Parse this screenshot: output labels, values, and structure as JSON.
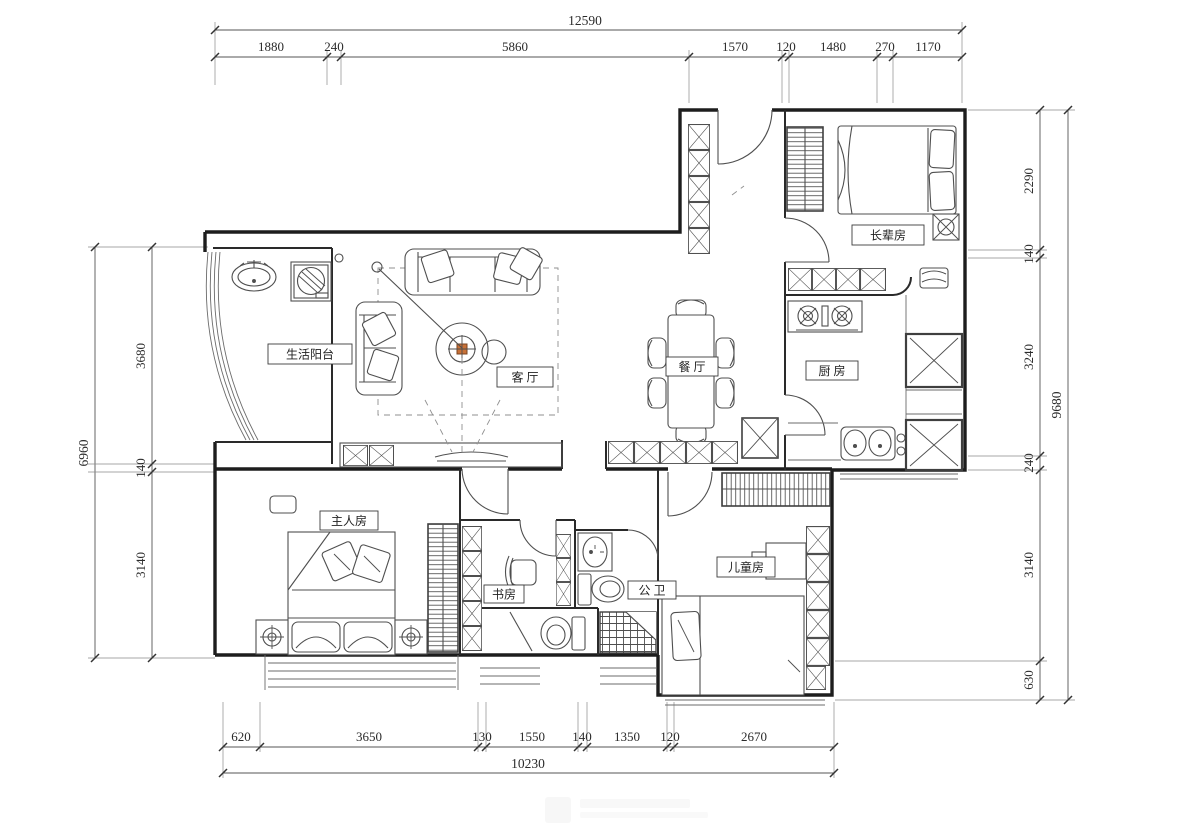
{
  "drawing": {
    "type": "apartment floor plan",
    "line_color": "#3c3c3c",
    "wall_color": "#1d1d1d",
    "accent_color": "#c87137",
    "background": "#ffffff"
  },
  "rooms": {
    "balcony": {
      "label": "生活阳台"
    },
    "living": {
      "label": "客 厅"
    },
    "dining": {
      "label": "餐 厅"
    },
    "elder": {
      "label": "长辈房"
    },
    "kitchen": {
      "label": "厨 房"
    },
    "master": {
      "label": "主人房"
    },
    "study": {
      "label": "书房"
    },
    "bathroom": {
      "label": "公 卫"
    },
    "kids": {
      "label": "儿童房"
    }
  },
  "dimensions": {
    "top": {
      "total": "12590",
      "segments": [
        "1880",
        "240",
        "5860",
        "1570",
        "120",
        "1480",
        "270",
        "1170"
      ]
    },
    "bottom": {
      "total": "10230",
      "segments": [
        "620",
        "3650",
        "130",
        "1550",
        "140",
        "1350",
        "120",
        "2670"
      ]
    },
    "left": {
      "total": "6960",
      "segments": [
        "3680",
        "140",
        "3140"
      ]
    },
    "right": {
      "total": "9680",
      "segments": [
        "2290",
        "140",
        "3240",
        "240",
        "3140",
        "630"
      ]
    }
  }
}
